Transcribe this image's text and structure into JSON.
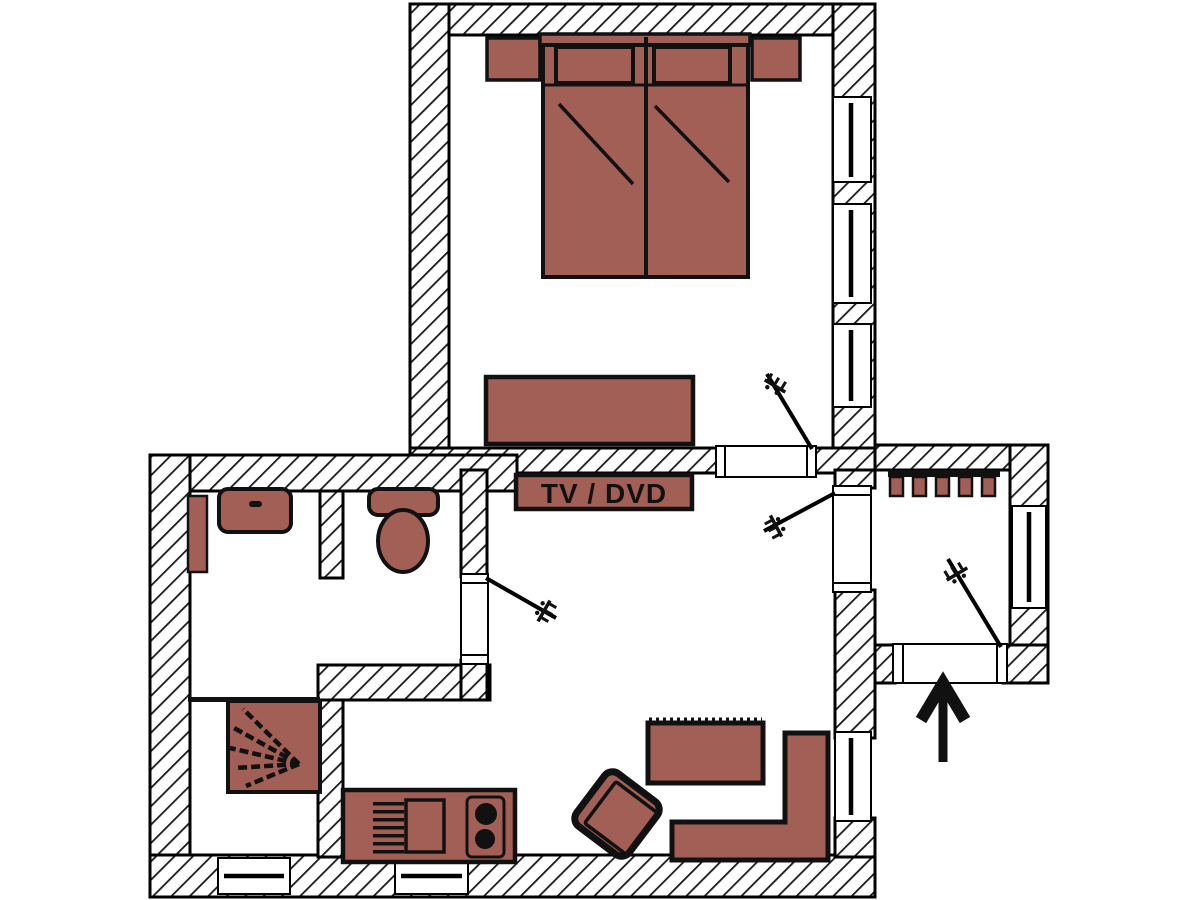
{
  "labels": {
    "tv_dvd": "TV / DVD"
  },
  "colors": {
    "furniture": "#a25f55",
    "outline": "#111111",
    "wall_fill": "#ffffff",
    "hatch_line": "#1a1a1a",
    "background": "#ffffff"
  },
  "icons": {
    "entrance_arrow": "up-arrow",
    "door_handle": "handle-glyph",
    "shower_spray": "fan-lines"
  }
}
